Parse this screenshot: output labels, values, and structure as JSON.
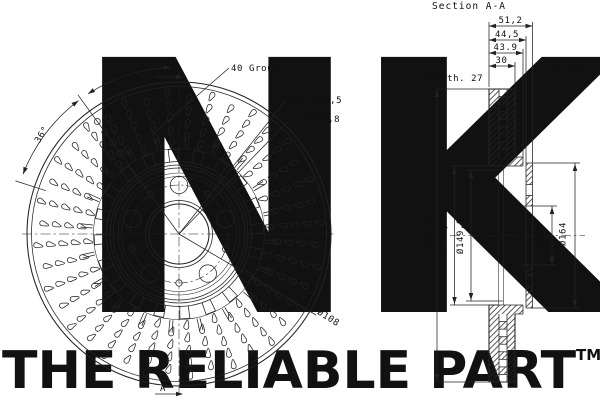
{
  "watermark": {
    "brand": "NK",
    "brand_tm": "TM",
    "slogan": "THE RELIABLE PART",
    "slogan_tm": "TM",
    "color": "#d9d9d9"
  },
  "section": {
    "title": "Section A-A",
    "top_dims": [
      "51,2",
      "44,5",
      "43.9",
      "30"
    ],
    "min_thickness": "Min th. 27",
    "dia_dims": [
      "Ø335,8",
      "Ø153,7",
      "Ø149,9",
      "Ø68",
      "Ø164"
    ]
  },
  "front": {
    "groups_label": "40 Groups",
    "holes_large": "5 X Ø16,5",
    "holes_small": "5 X Ø6,8",
    "bolt_circle": "Ø108",
    "angle1": "36°",
    "angle2": "36°",
    "marker_top": "A",
    "marker_bottom": "A"
  }
}
